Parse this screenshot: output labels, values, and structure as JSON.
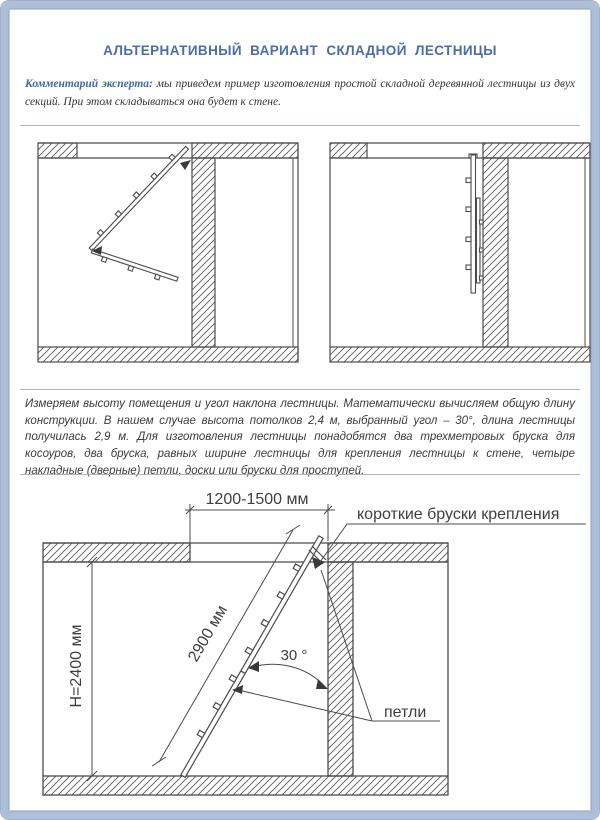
{
  "colors": {
    "frame": "#aec0da",
    "frame_edge": "#9db0cc",
    "separator": "#a9b6c7",
    "title": "#4a6da8",
    "comment_accent": "#3c6aa6",
    "body_text": "#3c3c3c",
    "drawing_line": "#4c4c4c"
  },
  "header": {
    "title": "АЛЬТЕРНАТИВНЫЙ ВАРИАНТ СКЛАДНОЙ ЛЕСТНИЦЫ"
  },
  "comment": {
    "label": "Комментарий эксперта:",
    "text": "мы приведем пример изготовления простой складной деревянной лестницы из двух секций. При этом складываться она будет к стене."
  },
  "body": {
    "paragraph": "Измеряем высоту помещения и угол наклона лестницы. Математически вычисляем общую длину конструкции. В нашем случае высота потолков 2,4 м, выбранный угол – 30°, длина лестницы получилась 2,9 м. Для изготовления лестницы понадобятся два трехметровых бруска для косоуров, два бруска, равных ширине лестницы для крепления лестницы к стене, четыре накладные (дверные) петли, доски или бруски для проступей."
  },
  "diagram": {
    "width_range": "1200-1500 мм",
    "mount_bars_label": "короткие бруски крепления",
    "room_height": "Н=2400 мм",
    "ladder_length": "2900 мм",
    "angle": "30 °",
    "hinges_label": "петли"
  }
}
